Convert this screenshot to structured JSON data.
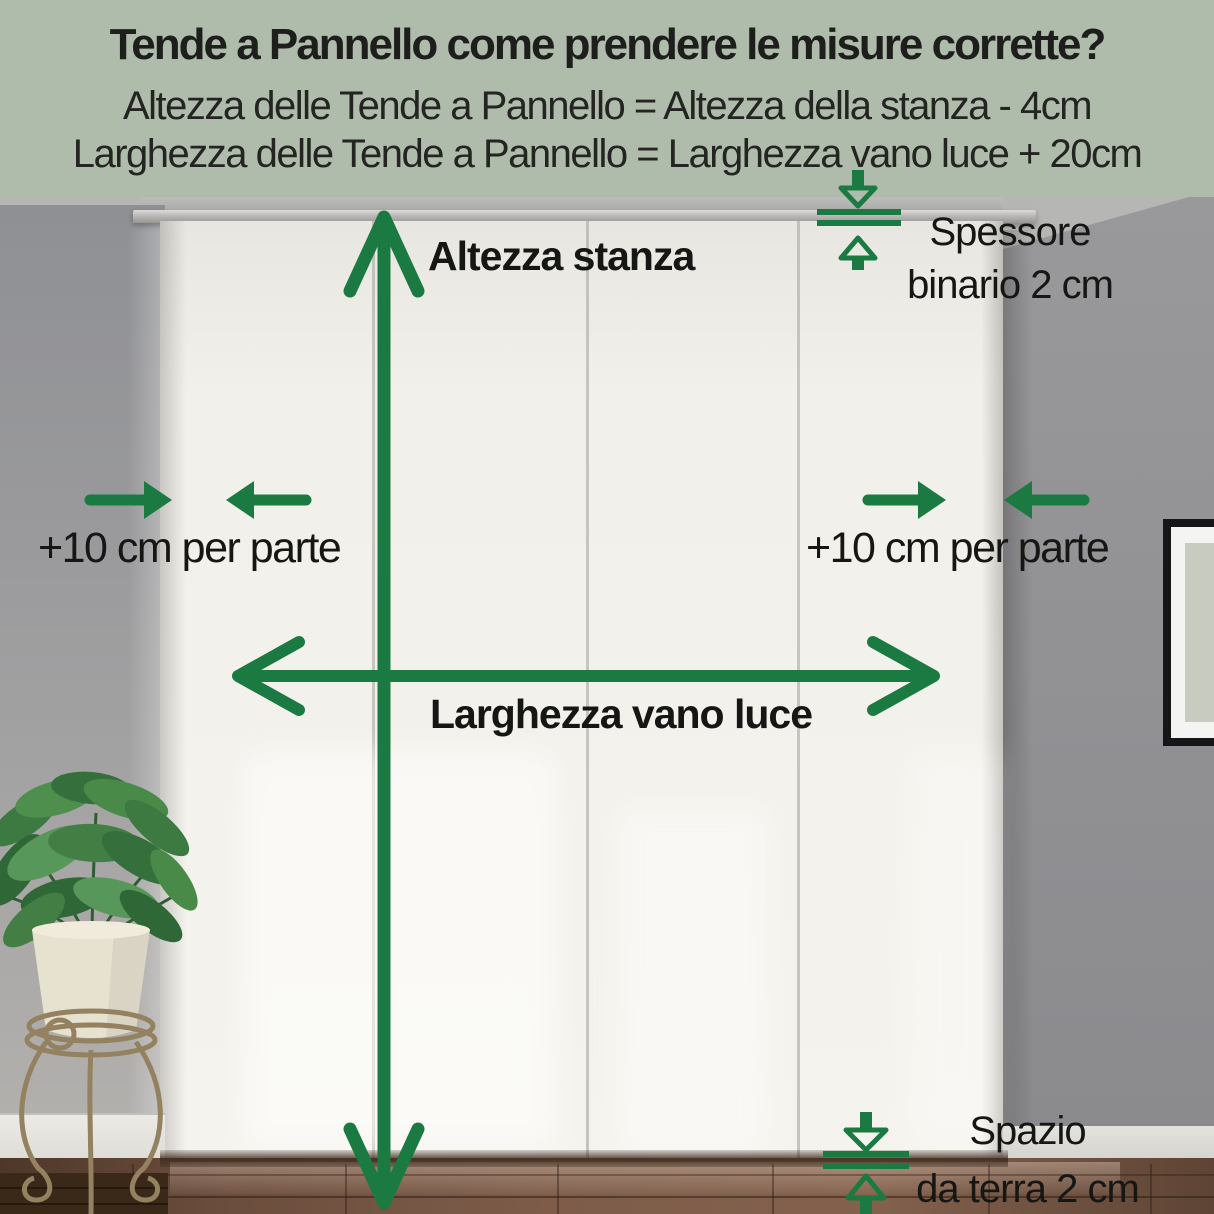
{
  "header": {
    "title": "Tende a Pannello come prendere le misure corrette?",
    "formula_height": "Altezza delle Tende a Pannello = Altezza della stanza - 4cm",
    "formula_width": "Larghezza delle Tende a Pannello = Larghezza vano luce + 20cm"
  },
  "annotations": {
    "room_height": "Altezza stanza",
    "opening_width": "Larghezza vano luce",
    "side_allowance_left": "+10 cm per parte",
    "side_allowance_right": "+10 cm per parte",
    "track": {
      "line1": "Spessore",
      "line2": "binario 2 cm"
    },
    "floor_gap": {
      "line1": "Spazio",
      "line2": "da terra 2 cm"
    }
  },
  "colors": {
    "accent_green": "#1b7a41",
    "header_background": "#afbcab",
    "curtain": "#f2f0ea",
    "wall_gray": "#919194",
    "floor_brown": "#6b4d3d"
  },
  "icons": [
    "vertical-double-arrow-icon",
    "horizontal-double-arrow-icon",
    "inward-arrows-left-icon",
    "inward-arrows-right-icon",
    "track-thickness-gap-icon",
    "floor-gap-icon"
  ]
}
